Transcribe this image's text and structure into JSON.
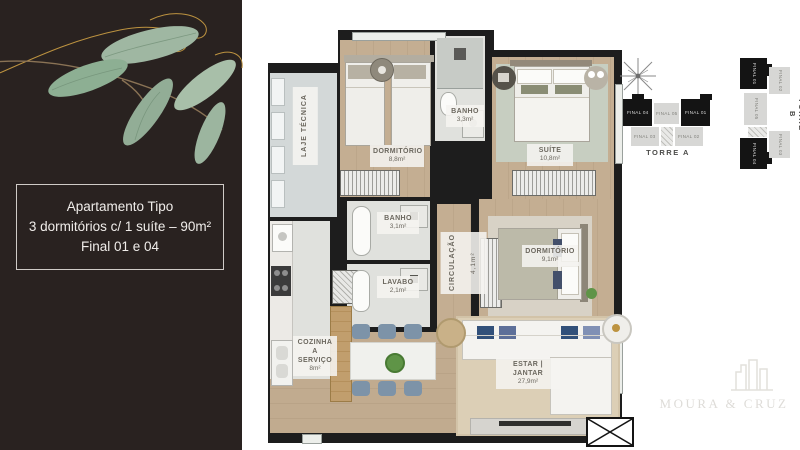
{
  "panel": {
    "line1": "Apartamento Tipo",
    "line2": "3 dormitórios c/ 1 suíte – 90m²",
    "line3": "Final 01 e 04"
  },
  "plan": {
    "rooms": {
      "laje": {
        "name": "LAJE TÉCNICA",
        "area": ""
      },
      "dorm1": {
        "name": "DORMITÓRIO",
        "area": "8,8m²"
      },
      "banho1": {
        "name": "BANHO",
        "area": "3,3m²"
      },
      "suite": {
        "name": "SUÍTE",
        "area": "10,8m²"
      },
      "banho2": {
        "name": "BANHO",
        "area": "3,1m²"
      },
      "lavabo": {
        "name": "LAVABO",
        "area": "2,1m²"
      },
      "circulacao": {
        "name": "CIRCULAÇÃO",
        "area": "4,1m²"
      },
      "dorm2": {
        "name": "DORMITÓRIO",
        "area": "9,1m²"
      },
      "cozinha": {
        "name": "COZINHA A SERVIÇO",
        "area": "8m²"
      },
      "estar": {
        "name": "ESTAR | JANTAR",
        "area": "27,9m²"
      }
    }
  },
  "towers": {
    "torre_a": {
      "label": "TORRE A",
      "units": {
        "u04": "FINAL 04",
        "u05": "FINAL 05",
        "u01": "FINAL 01",
        "u03": "FINAL 03",
        "u02": "FINAL 02"
      }
    },
    "torre_b": {
      "label": "TORRE B",
      "units": {
        "u01": "FINAL 01",
        "u02": "FINAL 02",
        "u05": "FINAL 05",
        "u03": "FINAL 03",
        "u04": "FINAL 04"
      }
    }
  },
  "watermark": {
    "name": "MOURA & CRUZ"
  },
  "colors": {
    "panel_bg": "#292220",
    "wall": "#1d1d1d",
    "wood_floor": "#c4ae92",
    "tile_floor": "#e0e1dd",
    "laje_floor": "#d3d8d8",
    "rug_living": "#dccfb6",
    "rug_suite": "#c7cec1",
    "highlight_unit": "#141414",
    "leaf_green": "#9cb49e",
    "gold": "#bd9340",
    "chair_blue": "#7d93a8",
    "pillow_navy": "#31507a"
  }
}
